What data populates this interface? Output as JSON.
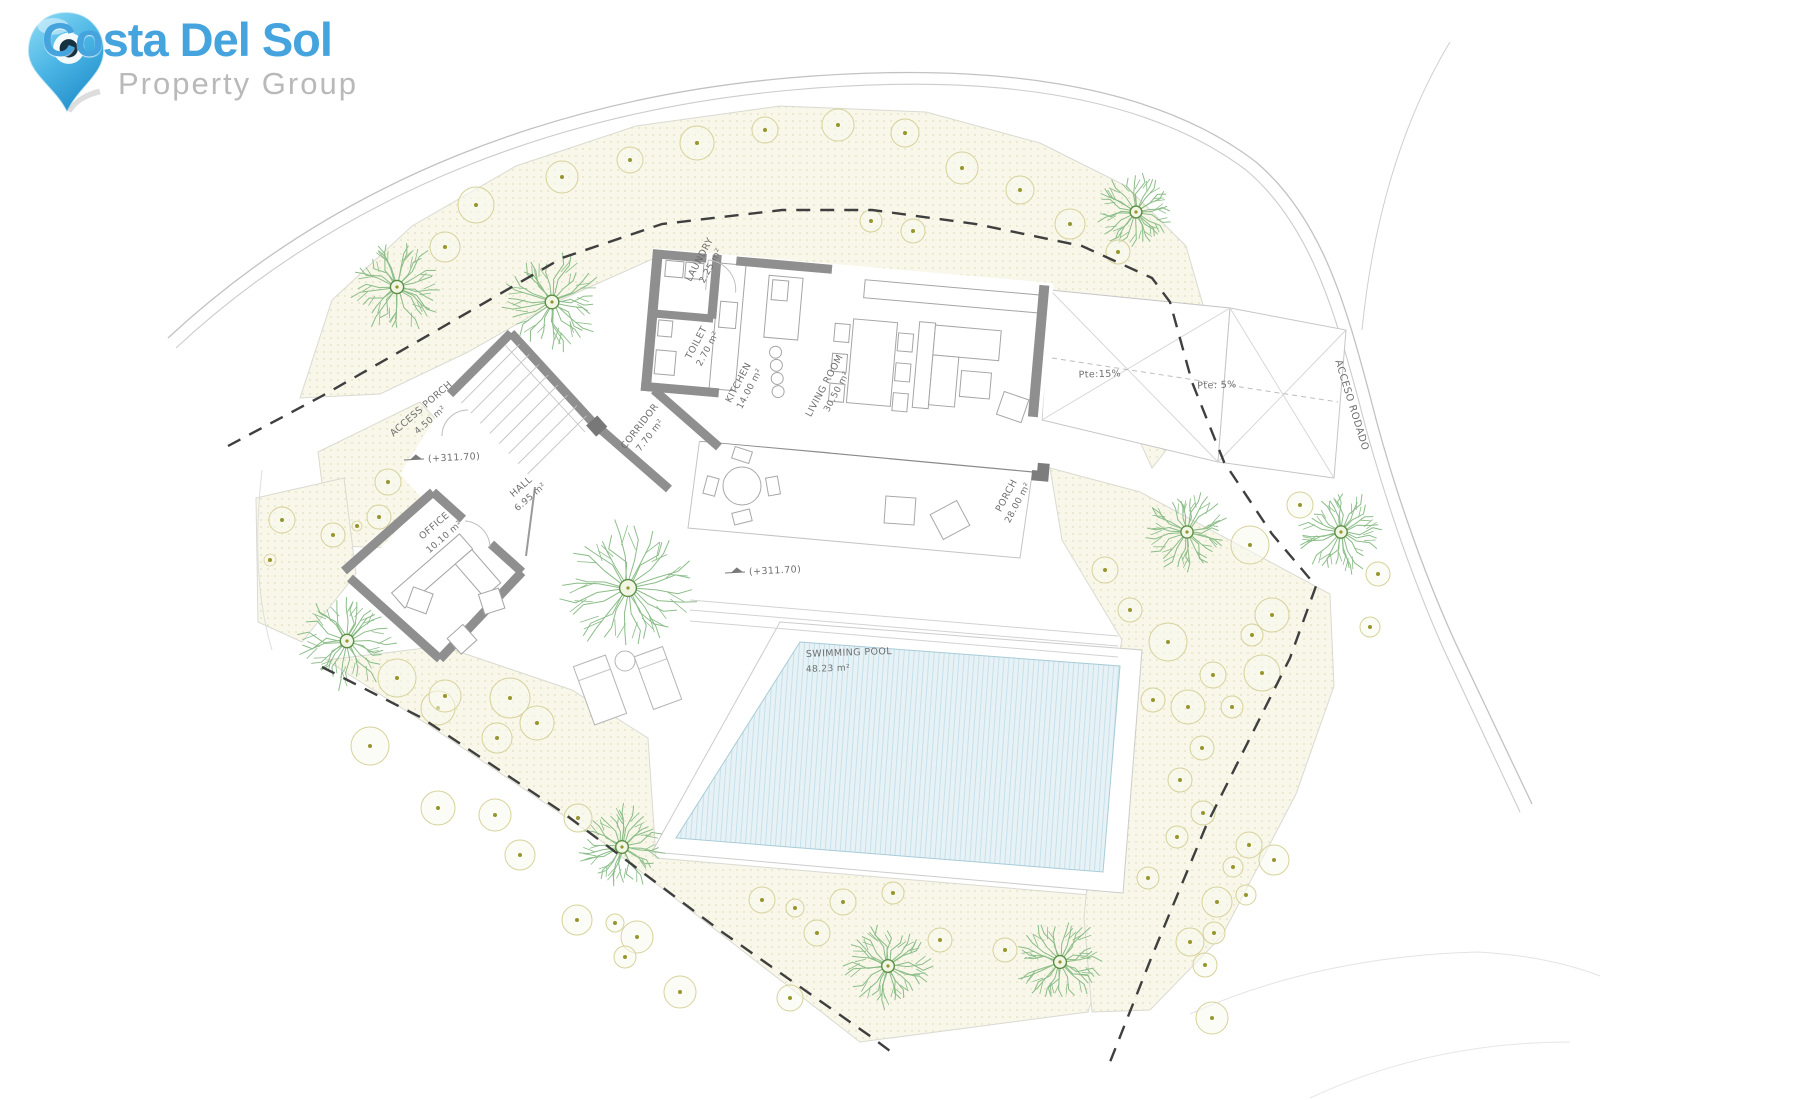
{
  "logo": {
    "brand": "Costa Del Sol",
    "subtitle": "Property Group",
    "brand_color": "#45a4de",
    "subtitle_color": "#b9b9b9",
    "pin_color": "#2e9fd6"
  },
  "plan": {
    "colors": {
      "label": "#6f6f6f",
      "terrain_fill": "#f8f7ea",
      "terrain_dot": "#e3e0bc",
      "terrain_edge": "#dadad2",
      "road": "#c9c9c9",
      "contour": "#e3e3e3",
      "boundary": "#3f3f3f",
      "wall": "#8f8f8f",
      "furniture": "#a0a0a0",
      "pool_fill": "#e6f2f6",
      "pool_hatch": "#c8e0ea",
      "tree_branch": "#8bbd88",
      "tree_center": "#5c8f45",
      "bush_ring": "#d6d29a",
      "bush_dot": "#96962f"
    },
    "elevation_text": "(+311.70)",
    "elevations": [
      {
        "x": 424,
        "y": 459,
        "rot": -3
      },
      {
        "x": 745,
        "y": 572,
        "rot": -3
      }
    ],
    "labels": [
      {
        "id": "laundry-name",
        "text": "LAUNDRY",
        "x": 702,
        "y": 261,
        "rot": -62,
        "size": 9.5
      },
      {
        "id": "laundry-area",
        "text": "2.25 m²",
        "x": 713,
        "y": 267,
        "rot": -62,
        "size": 9
      },
      {
        "id": "toilet-name",
        "text": "TOILET",
        "x": 699,
        "y": 344,
        "rot": -62,
        "size": 9.5
      },
      {
        "id": "toilet-area",
        "text": "2.70 m²",
        "x": 710,
        "y": 350,
        "rot": -62,
        "size": 9
      },
      {
        "id": "kitchen-name",
        "text": "KITCHEN",
        "x": 741,
        "y": 384,
        "rot": -62,
        "size": 9.5
      },
      {
        "id": "kitchen-area",
        "text": "14.00 m²",
        "x": 752,
        "y": 390,
        "rot": -62,
        "size": 9
      },
      {
        "id": "living-room-name",
        "text": "LIVING ROOM",
        "x": 827,
        "y": 387,
        "rot": -62,
        "size": 9.5
      },
      {
        "id": "living-room-area",
        "text": "30.50 m²",
        "x": 839,
        "y": 393,
        "rot": -62,
        "size": 9
      },
      {
        "id": "corridor-name",
        "text": "CORRIDOR",
        "x": 642,
        "y": 428,
        "rot": -52,
        "size": 9.5
      },
      {
        "id": "corridor-area",
        "text": "7.70 m²",
        "x": 652,
        "y": 437,
        "rot": -52,
        "size": 9
      },
      {
        "id": "access-porch-name",
        "text": "ACCESS PORCH",
        "x": 423,
        "y": 411,
        "rot": -41,
        "size": 9.5
      },
      {
        "id": "access-porch-area",
        "text": "4.50 m²",
        "x": 432,
        "y": 422,
        "rot": -41,
        "size": 9
      },
      {
        "id": "hall-name",
        "text": "HALL",
        "x": 523,
        "y": 489,
        "rot": -41,
        "size": 9.5
      },
      {
        "id": "hall-area",
        "text": "6.95 m²",
        "x": 532,
        "y": 499,
        "rot": -41,
        "size": 9
      },
      {
        "id": "office-name",
        "text": "OFFICE",
        "x": 436,
        "y": 528,
        "rot": -41,
        "size": 9.5
      },
      {
        "id": "office-area",
        "text": "10.10 m²",
        "x": 446,
        "y": 539,
        "rot": -41,
        "size": 9
      },
      {
        "id": "porch-name",
        "text": "PORCH",
        "x": 1009,
        "y": 497,
        "rot": -62,
        "size": 9.5
      },
      {
        "id": "porch-area",
        "text": "28.00 m²",
        "x": 1020,
        "y": 504,
        "rot": -62,
        "size": 9
      },
      {
        "id": "pool-name",
        "text": "SWIMMING POOL",
        "x": 806,
        "y": 657,
        "rot": -2,
        "size": 9.5,
        "anchor": "start"
      },
      {
        "id": "pool-area",
        "text": "48.23 m²",
        "x": 806,
        "y": 672,
        "rot": -2,
        "size": 9,
        "anchor": "start"
      },
      {
        "id": "ramp-15",
        "text": "Pte:15%",
        "x": 1100,
        "y": 377,
        "rot": -2,
        "size": 9.5
      },
      {
        "id": "ramp-5",
        "text": "Pte: 5%",
        "x": 1217,
        "y": 388,
        "rot": -2,
        "size": 9.5
      },
      {
        "id": "road-name",
        "text": "ACCESO RODADO",
        "x": 1349,
        "y": 406,
        "rot": 73,
        "size": 10
      }
    ],
    "terrain": [
      {
        "name": "terrain-upper-band",
        "points": "300,398 332,300 412,226 516,166 636,126 780,106 926,112 1040,143 1126,186 1186,246 1208,322 1190,420 1152,468 1130,420 1090,330 1052,295 832,270 664,254 556,302 468,352 380,394"
      },
      {
        "name": "terrain-entry-strip",
        "points": "318,452 420,402 464,450 404,548 330,546"
      },
      {
        "name": "terrain-office-strip",
        "points": "256,498 344,478 356,574 302,642 258,622"
      },
      {
        "name": "terrain-south-garden",
        "points": "326,660 442,646 572,690 648,738 656,858 1125,898 1088,1012 860,1042 600,840 430,726"
      },
      {
        "name": "terrain-east-garden",
        "points": "1050,468 1140,492 1330,594 1334,686 1296,794 1222,936 1150,1010 1092,1012 1084,918 1100,748 1122,640 1062,540"
      }
    ],
    "roads": [
      {
        "name": "road-outer-edge",
        "d": "M168,338 C340,178 560,98 788,78 C985,61 1152,82 1256,162 C1322,218 1346,306 1370,396 C1392,484 1424,574 1456,644 L1532,804",
        "w": 1.3,
        "c": "#c2c2c2"
      },
      {
        "name": "road-inner-edge",
        "d": "M176,348 C346,190 566,110 792,90 C980,73 1142,92 1246,170 C1310,224 1334,310 1358,398 C1380,486 1412,578 1444,650 L1520,812",
        "w": 1.1,
        "c": "#cccccc"
      },
      {
        "name": "road-branch",
        "d": "M1362,330 C1372,230 1398,128 1450,42",
        "w": 1,
        "c": "#cfcfcf"
      },
      {
        "name": "contour-line-1",
        "d": "M1190,1014 Q1320,956 1478,952 Q1548,956 1600,976",
        "w": 1,
        "c": "#e3e3e3"
      },
      {
        "name": "contour-line-2",
        "d": "M1310,1098 Q1430,1042 1570,1042",
        "w": 1,
        "c": "#e6e6e6"
      },
      {
        "name": "contour-line-3",
        "d": "M262,470 C254,540 257,600 272,650",
        "w": 1,
        "c": "#dedede"
      }
    ],
    "boundaries": [
      {
        "name": "property-boundary-north",
        "points": "228,446 322,396 434,332 562,258 662,224 782,210 872,210 976,224 1082,246 1152,278 1170,302 1192,382 1224,462 1272,534 1316,586 1290,658 1246,746 1206,826 1152,956 1110,1062"
      },
      {
        "name": "property-boundary-southwest",
        "points": "322,667 422,718 562,812 722,932 870,1036 894,1054"
      }
    ],
    "trees": [
      {
        "x": 397,
        "y": 287,
        "r": 45
      },
      {
        "x": 552,
        "y": 302,
        "r": 48
      },
      {
        "x": 347,
        "y": 641,
        "r": 47
      },
      {
        "x": 628,
        "y": 588,
        "r": 66
      },
      {
        "x": 622,
        "y": 847,
        "r": 42
      },
      {
        "x": 888,
        "y": 966,
        "r": 42
      },
      {
        "x": 1060,
        "y": 962,
        "r": 43
      },
      {
        "x": 1136,
        "y": 212,
        "r": 38
      },
      {
        "x": 1187,
        "y": 532,
        "r": 40
      },
      {
        "x": 1341,
        "y": 532,
        "r": 41
      }
    ],
    "bushes": [
      [
        445,
        247,
        15
      ],
      [
        476,
        205,
        18
      ],
      [
        562,
        177,
        16
      ],
      [
        630,
        160,
        13
      ],
      [
        697,
        143,
        17
      ],
      [
        765,
        130,
        13
      ],
      [
        838,
        125,
        16
      ],
      [
        905,
        133,
        14
      ],
      [
        962,
        168,
        16
      ],
      [
        1020,
        190,
        14
      ],
      [
        1070,
        224,
        15
      ],
      [
        1118,
        252,
        12
      ],
      [
        871,
        221,
        11
      ],
      [
        913,
        231,
        12
      ],
      [
        388,
        482,
        13
      ],
      [
        379,
        517,
        12
      ],
      [
        357,
        526,
        5
      ],
      [
        333,
        535,
        12
      ],
      [
        397,
        678,
        19
      ],
      [
        438,
        708,
        17
      ],
      [
        370,
        746,
        19
      ],
      [
        282,
        520,
        13
      ],
      [
        270,
        560,
        6
      ],
      [
        445,
        696,
        16
      ],
      [
        510,
        698,
        20
      ],
      [
        537,
        723,
        17
      ],
      [
        497,
        738,
        15
      ],
      [
        438,
        808,
        17
      ],
      [
        495,
        815,
        16
      ],
      [
        520,
        855,
        15
      ],
      [
        578,
        818,
        14
      ],
      [
        577,
        920,
        15
      ],
      [
        615,
        923,
        9
      ],
      [
        637,
        937,
        16
      ],
      [
        625,
        957,
        11
      ],
      [
        680,
        992,
        16
      ],
      [
        762,
        900,
        13
      ],
      [
        795,
        908,
        9
      ],
      [
        817,
        933,
        13
      ],
      [
        843,
        902,
        13
      ],
      [
        893,
        893,
        11
      ],
      [
        790,
        998,
        13
      ],
      [
        940,
        940,
        12
      ],
      [
        1005,
        950,
        12
      ],
      [
        1168,
        642,
        19
      ],
      [
        1252,
        635,
        11
      ],
      [
        1213,
        675,
        13
      ],
      [
        1262,
        673,
        18
      ],
      [
        1153,
        700,
        12
      ],
      [
        1188,
        707,
        17
      ],
      [
        1232,
        707,
        11
      ],
      [
        1202,
        748,
        12
      ],
      [
        1180,
        780,
        12
      ],
      [
        1203,
        813,
        12
      ],
      [
        1177,
        837,
        11
      ],
      [
        1249,
        845,
        13
      ],
      [
        1274,
        860,
        15
      ],
      [
        1233,
        867,
        10
      ],
      [
        1217,
        902,
        15
      ],
      [
        1246,
        895,
        10
      ],
      [
        1214,
        933,
        11
      ],
      [
        1148,
        878,
        11
      ],
      [
        1190,
        942,
        14
      ],
      [
        1205,
        965,
        12
      ],
      [
        1212,
        1018,
        16
      ],
      [
        1370,
        627,
        10
      ],
      [
        1378,
        574,
        12
      ],
      [
        1300,
        505,
        13
      ],
      [
        1250,
        545,
        19
      ],
      [
        1272,
        615,
        17
      ],
      [
        1105,
        570,
        13
      ],
      [
        1130,
        610,
        12
      ]
    ]
  }
}
